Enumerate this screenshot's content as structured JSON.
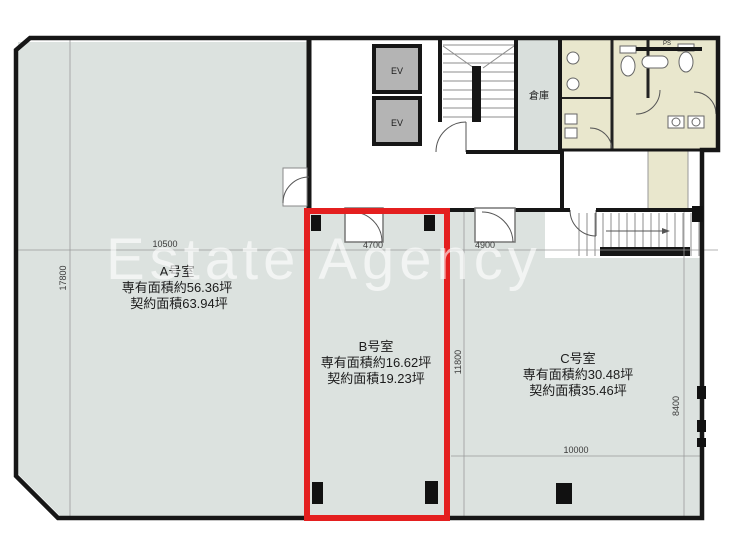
{
  "watermark_text": "Estate Agency",
  "rooms": {
    "a": {
      "name": "A号室",
      "exclusive_area": "専有面積約56.36坪",
      "contract_area": "契約面積63.94坪"
    },
    "b": {
      "name": "B号室",
      "exclusive_area": "専有面積約16.62坪",
      "contract_area": "契約面積19.23坪",
      "highlighted": true
    },
    "c": {
      "name": "C号室",
      "exclusive_area": "専有面積約30.48坪",
      "contract_area": "契約面積35.46坪"
    }
  },
  "labels": {
    "ev_upper": "EV",
    "ev_lower": "EV",
    "storage": "倉庫",
    "pipe_space": "PS"
  },
  "dimensions": {
    "overall_top_left": "10500",
    "overall_left_vertical": "17800",
    "room_b_width": "4700",
    "room_c_width_upper": "4900",
    "room_c_height_vertical": "11800",
    "overall_right_vertical": "8400",
    "room_c_width_lower": "10000"
  },
  "colors": {
    "floor_gray": "#dce2df",
    "restroom_beige": "#e9e7cd",
    "highlight_red": "#e41f1f",
    "wall_black": "#161616",
    "elevator_gray": "#b4b4b4",
    "watermark_white": "rgba(255,255,255,0.62)"
  }
}
